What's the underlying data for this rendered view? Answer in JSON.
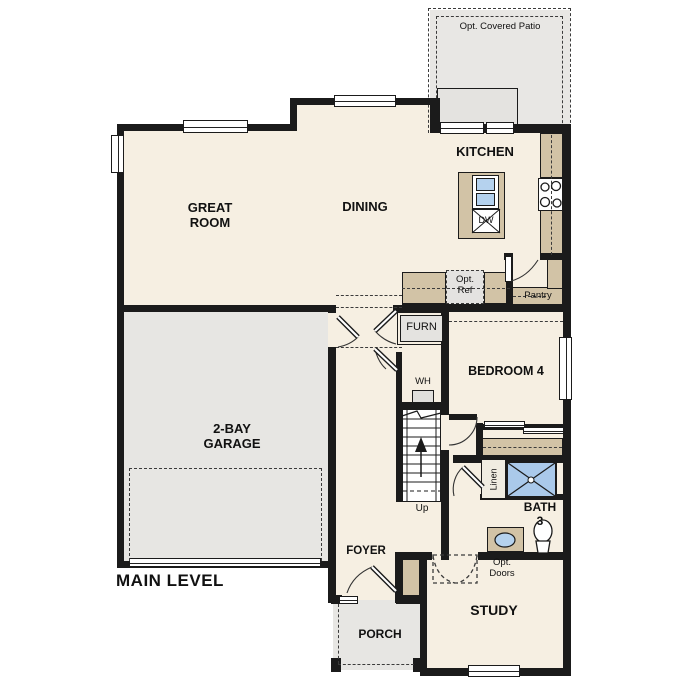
{
  "title": "MAIN LEVEL",
  "colors": {
    "wall": "#1b1b1b",
    "floor": "#f6efe2",
    "garage_floor": "#e7e6e3",
    "patio_floor": "#e8e7e4",
    "cabinet_tan": "#d2c3a6",
    "shower_blue": "#aac9ea",
    "sink_blue": "#b5d2ee",
    "fixture_gray": "#e4e3e0"
  },
  "rooms": {
    "great_room": [
      "GREAT",
      "ROOM"
    ],
    "dining": "DINING",
    "kitchen": "KITCHEN",
    "garage": [
      "2-BAY",
      "GARAGE"
    ],
    "bedroom4": "BEDROOM 4",
    "bath": [
      "BATH",
      "3"
    ],
    "study": "STUDY",
    "foyer": "FOYER",
    "porch": "PORCH",
    "pantry": "Pantry"
  },
  "features": {
    "patio": "Opt. Covered Patio",
    "opt_ref": [
      "Opt.",
      "Ref"
    ],
    "opt_doors": [
      "Opt.",
      "Doors"
    ],
    "furnace": "FURN",
    "water_heater": "WH",
    "up": "Up",
    "linen": "Linen",
    "dishwasher": "DW"
  }
}
